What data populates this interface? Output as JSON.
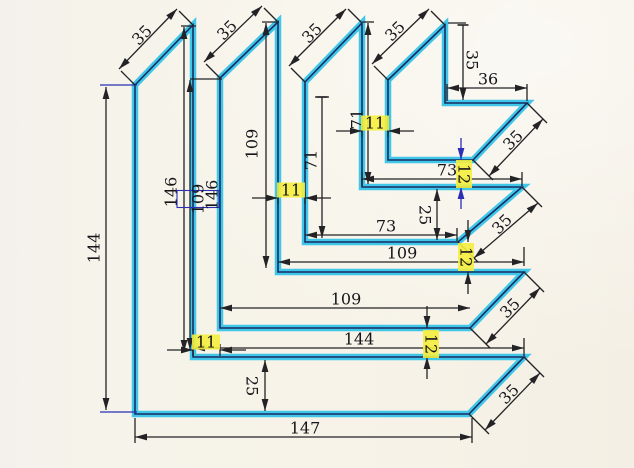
{
  "title": "nested-angle-profiles-dimension-sketch",
  "canvas": {
    "width": 634,
    "height": 468
  },
  "colors": {
    "paper": "#f6f3ea",
    "marker_cyan": "#3fc6e8",
    "ink_navy": "#12124a",
    "dim_black": "#232326",
    "dim_blue": "#2a2fb5",
    "highlight_yellow": "#f4ee3e",
    "text": "#15151a"
  },
  "chart_data": {
    "type": "diagram",
    "description": "Four nested L-shaped angle profiles with mitered ends, hand-traced in cyan marker, fully dimensioned",
    "profiles_mm": [
      {
        "name": "profile-1-outer",
        "vertical_outer": 144,
        "vertical_inner": 146,
        "horizontal_top": 144,
        "horizontal_bottom": 147,
        "leg_width": 25,
        "miter": 35
      },
      {
        "name": "profile-2",
        "vertical_outer": 109,
        "vertical_inner": 109,
        "horizontal_top": 109,
        "horizontal_bottom": 109,
        "leg_width": 25,
        "miter": 35
      },
      {
        "name": "profile-3",
        "vertical_outer": 71,
        "vertical_inner": 71,
        "horizontal_top": 73,
        "horizontal_bottom": 73,
        "leg_width": 25,
        "miter": 35
      },
      {
        "name": "profile-4-inner",
        "vertical_inner": 35,
        "horizontal_top": 36,
        "miter": 35
      },
      {
        "gap_between_vertical_legs": 11,
        "gap_between_horizontal_legs": 12
      }
    ]
  },
  "drawing": {
    "profiles": [
      {
        "id": "profile-1",
        "points": [
          [
            135,
            85
          ],
          [
            193,
            25
          ],
          [
            193,
            357
          ],
          [
            524,
            357
          ],
          [
            469,
            414
          ],
          [
            135,
            414
          ]
        ]
      },
      {
        "id": "profile-2",
        "points": [
          [
            220,
            78
          ],
          [
            278,
            22
          ],
          [
            278,
            272
          ],
          [
            524,
            272
          ],
          [
            470,
            328
          ],
          [
            220,
            328
          ]
        ]
      },
      {
        "id": "profile-3",
        "points": [
          [
            305,
            82
          ],
          [
            362,
            23
          ],
          [
            362,
            187
          ],
          [
            522,
            187
          ],
          [
            458,
            242
          ],
          [
            305,
            242
          ]
        ]
      },
      {
        "id": "profile-4",
        "points": [
          [
            388,
            80
          ],
          [
            445,
            25
          ],
          [
            445,
            103
          ],
          [
            527,
            103
          ],
          [
            473,
            160
          ],
          [
            388,
            160
          ]
        ]
      }
    ],
    "ext_lines": [
      {
        "x1": 100,
        "y1": 85,
        "x2": 137,
        "y2": 85,
        "c": "blue"
      },
      {
        "x1": 100,
        "y1": 412,
        "x2": 137,
        "y2": 412,
        "c": "blue"
      },
      {
        "x1": 135,
        "y1": 418,
        "x2": 135,
        "y2": 443
      },
      {
        "x1": 472,
        "y1": 418,
        "x2": 472,
        "y2": 443
      },
      {
        "x1": 190,
        "y1": 79,
        "x2": 222,
        "y2": 79
      },
      {
        "x1": 181,
        "y1": 26,
        "x2": 196,
        "y2": 26
      },
      {
        "x1": 262,
        "y1": 22,
        "x2": 279,
        "y2": 22
      },
      {
        "x1": 363,
        "y1": 22,
        "x2": 374,
        "y2": 22
      },
      {
        "x1": 448,
        "y1": 23,
        "x2": 466,
        "y2": 23
      },
      {
        "x1": 447,
        "y1": 84,
        "x2": 447,
        "y2": 101
      },
      {
        "x1": 527,
        "y1": 84,
        "x2": 527,
        "y2": 101
      },
      {
        "x1": 362,
        "y1": 172,
        "x2": 362,
        "y2": 186
      },
      {
        "x1": 522,
        "y1": 172,
        "x2": 522,
        "y2": 186
      },
      {
        "x1": 457,
        "y1": 228,
        "x2": 457,
        "y2": 241
      },
      {
        "x1": 524,
        "y1": 247,
        "x2": 524,
        "y2": 266
      },
      {
        "x1": 524,
        "y1": 338,
        "x2": 524,
        "y2": 356
      },
      {
        "x1": 315,
        "y1": 97,
        "x2": 329,
        "y2": 97
      },
      {
        "x1": 121,
        "y1": 71,
        "x2": 135,
        "y2": 85
      },
      {
        "x1": 179,
        "y1": 11,
        "x2": 193,
        "y2": 25
      },
      {
        "x1": 206,
        "y1": 64,
        "x2": 220,
        "y2": 78
      },
      {
        "x1": 264,
        "y1": 8,
        "x2": 278,
        "y2": 22
      },
      {
        "x1": 291,
        "y1": 68,
        "x2": 305,
        "y2": 82
      },
      {
        "x1": 348,
        "y1": 9,
        "x2": 362,
        "y2": 23
      },
      {
        "x1": 374,
        "y1": 66,
        "x2": 388,
        "y2": 80
      },
      {
        "x1": 431,
        "y1": 11,
        "x2": 445,
        "y2": 25
      },
      {
        "x1": 469,
        "y1": 414,
        "x2": 489,
        "y2": 434
      },
      {
        "x1": 524,
        "y1": 357,
        "x2": 544,
        "y2": 377
      },
      {
        "x1": 470,
        "y1": 328,
        "x2": 490,
        "y2": 348
      },
      {
        "x1": 524,
        "y1": 272,
        "x2": 544,
        "y2": 292
      },
      {
        "x1": 458,
        "y1": 242,
        "x2": 478,
        "y2": 262
      },
      {
        "x1": 522,
        "y1": 187,
        "x2": 542,
        "y2": 207
      },
      {
        "x1": 473,
        "y1": 160,
        "x2": 493,
        "y2": 180
      },
      {
        "x1": 527,
        "y1": 103,
        "x2": 547,
        "y2": 123
      },
      {
        "x1": 362,
        "y1": 125,
        "x2": 362,
        "y2": 137
      },
      {
        "x1": 388,
        "y1": 125,
        "x2": 388,
        "y2": 137
      },
      {
        "x1": 278,
        "y1": 192,
        "x2": 278,
        "y2": 204
      },
      {
        "x1": 305,
        "y1": 192,
        "x2": 305,
        "y2": 204
      },
      {
        "x1": 193,
        "y1": 344,
        "x2": 193,
        "y2": 356
      },
      {
        "x1": 220,
        "y1": 344,
        "x2": 220,
        "y2": 356
      }
    ],
    "dims": [
      {
        "id": "dim-144-left",
        "lines": [
          {
            "x1": 106,
            "y1": 87,
            "x2": 106,
            "y2": 410,
            "a1": "arrow",
            "a2": "arrow"
          }
        ],
        "label": {
          "text": "144",
          "x": 94,
          "y": 248,
          "rot": -90
        }
      },
      {
        "id": "dim-146-a",
        "lines": [
          {
            "x1": 184,
            "y1": 27,
            "x2": 184,
            "y2": 352,
            "a1": "arrow",
            "a2": "arrow"
          }
        ],
        "label": {
          "text": "146",
          "x": 171,
          "y": 192,
          "rot": -90
        }
      },
      {
        "id": "dim-109-boxed",
        "lines": [
          {
            "x1": 190,
            "y1": 80,
            "x2": 190,
            "y2": 350,
            "a1": "arrow",
            "a2": "arrow"
          }
        ],
        "label": {
          "text": "109",
          "x": 198,
          "y": 199,
          "rot": -90,
          "box": [
            17,
            42
          ]
        }
      },
      {
        "id": "dim-146-b",
        "lines": [],
        "label": {
          "text": "146",
          "x": 212,
          "y": 195,
          "rot": -90
        }
      },
      {
        "id": "dim-109-left",
        "lines": [
          {
            "x1": 266,
            "y1": 23,
            "x2": 266,
            "y2": 268,
            "a1": "arrow",
            "a2": "arrow"
          }
        ],
        "label": {
          "text": "109",
          "x": 252,
          "y": 144,
          "rot": -90
        }
      },
      {
        "id": "dim-71-outer",
        "lines": [
          {
            "x1": 322,
            "y1": 97,
            "x2": 322,
            "y2": 238,
            "a1": "bar",
            "a2": "arrow"
          }
        ],
        "label": {
          "text": "71",
          "x": 311,
          "y": 160,
          "rot": -90
        }
      },
      {
        "id": "dim-71-inner",
        "lines": [
          {
            "x1": 368,
            "y1": 23,
            "x2": 368,
            "y2": 184,
            "a1": "arrow",
            "a2": "arrow"
          }
        ],
        "label": {
          "text": "71",
          "x": 357,
          "y": 119,
          "rot": -90
        }
      },
      {
        "id": "dim-35-vert",
        "lines": [
          {
            "x1": 463,
            "y1": 25,
            "x2": 463,
            "y2": 100,
            "a1": "bar",
            "a2": "arrow"
          }
        ],
        "label": {
          "text": "35",
          "x": 472,
          "y": 60,
          "rot": 90
        }
      },
      {
        "id": "dim-36",
        "lines": [
          {
            "x1": 447,
            "y1": 88,
            "x2": 527,
            "y2": 88,
            "a1": "arrow",
            "a2": "arrow"
          }
        ],
        "label": {
          "text": "36",
          "x": 488,
          "y": 79,
          "rot": 0
        }
      },
      {
        "id": "dim-73-a",
        "lines": [
          {
            "x1": 362,
            "y1": 179,
            "x2": 522,
            "y2": 179,
            "a1": "arrow",
            "a2": "arrow"
          }
        ],
        "label": {
          "text": "73",
          "x": 447,
          "y": 170,
          "rot": 0
        }
      },
      {
        "id": "dim-73-b",
        "lines": [
          {
            "x1": 305,
            "y1": 235,
            "x2": 457,
            "y2": 235,
            "a1": "arrow",
            "a2": "arrow"
          }
        ],
        "label": {
          "text": "73",
          "x": 386,
          "y": 226,
          "rot": 0
        }
      },
      {
        "id": "dim-109-b",
        "lines": [
          {
            "x1": 278,
            "y1": 262,
            "x2": 524,
            "y2": 262,
            "a1": "arrow",
            "a2": "arrow"
          }
        ],
        "label": {
          "text": "109",
          "x": 402,
          "y": 253,
          "rot": 0
        }
      },
      {
        "id": "dim-109-c",
        "lines": [
          {
            "x1": 220,
            "y1": 308,
            "x2": 470,
            "y2": 308,
            "a1": "arrow",
            "a2": "arrow"
          }
        ],
        "label": {
          "text": "109",
          "x": 346,
          "y": 299,
          "rot": 0
        }
      },
      {
        "id": "dim-144-b",
        "lines": [
          {
            "x1": 193,
            "y1": 348,
            "x2": 524,
            "y2": 348,
            "a1": "arrow",
            "a2": "arrow"
          }
        ],
        "label": {
          "text": "144",
          "x": 359,
          "y": 339,
          "rot": 0
        }
      },
      {
        "id": "dim-147",
        "lines": [
          {
            "x1": 135,
            "y1": 437,
            "x2": 472,
            "y2": 437,
            "a1": "arrow",
            "a2": "arrow"
          }
        ],
        "label": {
          "text": "147",
          "x": 305,
          "y": 428,
          "rot": 0
        }
      },
      {
        "id": "dim-25-right",
        "lines": [
          {
            "x1": 437,
            "y1": 189,
            "x2": 437,
            "y2": 240,
            "a1": "arrow",
            "a2": "arrow"
          }
        ],
        "label": {
          "text": "25",
          "x": 425,
          "y": 215,
          "rot": 90
        }
      },
      {
        "id": "dim-25-bottom",
        "lines": [
          {
            "x1": 265,
            "y1": 360,
            "x2": 265,
            "y2": 411,
            "a1": "arrow",
            "a2": "arrow"
          }
        ],
        "label": {
          "text": "25",
          "x": 252,
          "y": 386,
          "rot": 90
        }
      },
      {
        "id": "dim-11-a",
        "lines": [
          {
            "x1": 336,
            "y1": 131,
            "x2": 362,
            "y2": 131,
            "a2": "arrow"
          },
          {
            "x1": 414,
            "y1": 131,
            "x2": 388,
            "y2": 131,
            "a2": "arrow"
          }
        ],
        "label": {
          "text": "11",
          "x": 375,
          "y": 123,
          "rot": 0,
          "hl": [
            28,
            15
          ]
        }
      },
      {
        "id": "dim-11-b",
        "lines": [
          {
            "x1": 252,
            "y1": 198,
            "x2": 278,
            "y2": 198,
            "a2": "arrow"
          },
          {
            "x1": 331,
            "y1": 198,
            "x2": 305,
            "y2": 198,
            "a2": "arrow"
          }
        ],
        "label": {
          "text": "11",
          "x": 291,
          "y": 190,
          "rot": 0,
          "hl": [
            28,
            15
          ]
        }
      },
      {
        "id": "dim-11-c",
        "lines": [
          {
            "x1": 167,
            "y1": 350,
            "x2": 193,
            "y2": 350,
            "a2": "arrow"
          },
          {
            "x1": 246,
            "y1": 350,
            "x2": 220,
            "y2": 350,
            "a2": "arrow"
          }
        ],
        "label": {
          "text": "11",
          "x": 206,
          "y": 342,
          "rot": 0,
          "hl": [
            28,
            15
          ]
        }
      },
      {
        "id": "dim-12-a",
        "c": "blue",
        "lines": [
          {
            "x1": 461,
            "y1": 138,
            "x2": 461,
            "y2": 160,
            "a2": "arrow"
          },
          {
            "x1": 461,
            "y1": 209,
            "x2": 461,
            "y2": 187,
            "a2": "arrow"
          }
        ],
        "label": {
          "text": "12",
          "x": 464,
          "y": 174,
          "rot": 90,
          "hl": [
            16,
            28
          ]
        }
      },
      {
        "id": "dim-12-b",
        "lines": [
          {
            "x1": 468,
            "y1": 220,
            "x2": 468,
            "y2": 242,
            "a2": "arrow"
          },
          {
            "x1": 468,
            "y1": 294,
            "x2": 468,
            "y2": 272,
            "a2": "arrow"
          }
        ],
        "label": {
          "text": "12",
          "x": 466,
          "y": 257,
          "rot": 90,
          "hl": [
            16,
            28
          ]
        }
      },
      {
        "id": "dim-12-c",
        "lines": [
          {
            "x1": 427,
            "y1": 306,
            "x2": 427,
            "y2": 328,
            "a2": "arrow"
          },
          {
            "x1": 427,
            "y1": 379,
            "x2": 427,
            "y2": 357,
            "a2": "arrow"
          }
        ],
        "label": {
          "text": "12",
          "x": 431,
          "y": 344,
          "rot": 90,
          "hl": [
            16,
            28
          ]
        }
      },
      {
        "id": "dim-35-miter-top-1",
        "lines": [
          {
            "x1": 119,
            "y1": 69,
            "x2": 177,
            "y2": 9,
            "a1": "arrow",
            "a2": "arrow"
          }
        ],
        "label": {
          "text": "35",
          "x": 142,
          "y": 35,
          "rot": -45
        }
      },
      {
        "id": "dim-35-miter-top-2",
        "lines": [
          {
            "x1": 204,
            "y1": 62,
            "x2": 262,
            "y2": 6,
            "a1": "arrow",
            "a2": "arrow"
          }
        ],
        "label": {
          "text": "35",
          "x": 227,
          "y": 30,
          "rot": -45
        }
      },
      {
        "id": "dim-35-miter-top-3",
        "lines": [
          {
            "x1": 289,
            "y1": 66,
            "x2": 346,
            "y2": 9,
            "a1": "arrow",
            "a2": "arrow"
          }
        ],
        "label": {
          "text": "35",
          "x": 312,
          "y": 33,
          "rot": -45
        }
      },
      {
        "id": "dim-35-miter-top-4",
        "lines": [
          {
            "x1": 372,
            "y1": 64,
            "x2": 429,
            "y2": 9,
            "a1": "arrow",
            "a2": "arrow"
          }
        ],
        "label": {
          "text": "35",
          "x": 395,
          "y": 31,
          "rot": -45
        }
      },
      {
        "id": "dim-35-miter-right-4",
        "lines": [
          {
            "x1": 489,
            "y1": 176,
            "x2": 543,
            "y2": 119,
            "a1": "arrow",
            "a2": "arrow"
          }
        ],
        "label": {
          "text": "35",
          "x": 513,
          "y": 140,
          "rot": -45
        }
      },
      {
        "id": "dim-35-miter-right-3",
        "lines": [
          {
            "x1": 474,
            "y1": 258,
            "x2": 538,
            "y2": 203,
            "a1": "arrow",
            "a2": "arrow"
          }
        ],
        "label": {
          "text": "35",
          "x": 502,
          "y": 224,
          "rot": -45
        }
      },
      {
        "id": "dim-35-miter-right-2",
        "lines": [
          {
            "x1": 486,
            "y1": 344,
            "x2": 540,
            "y2": 288,
            "a1": "arrow",
            "a2": "arrow"
          }
        ],
        "label": {
          "text": "35",
          "x": 510,
          "y": 308,
          "rot": -45
        }
      },
      {
        "id": "dim-35-miter-right-1",
        "lines": [
          {
            "x1": 485,
            "y1": 430,
            "x2": 540,
            "y2": 373,
            "a1": "arrow",
            "a2": "arrow"
          }
        ],
        "label": {
          "text": "35",
          "x": 509,
          "y": 394,
          "rot": -45
        }
      }
    ]
  }
}
